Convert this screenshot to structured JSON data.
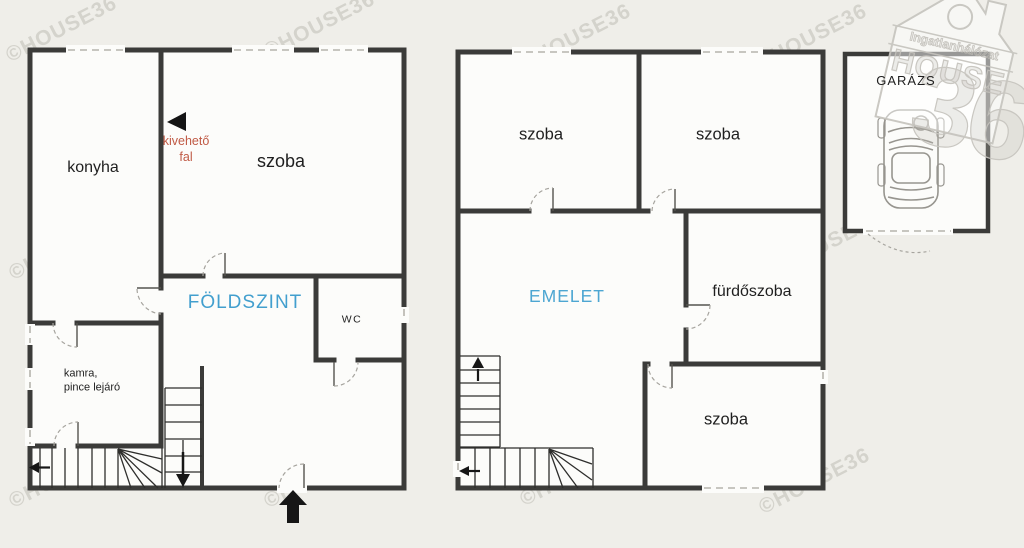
{
  "watermark": {
    "text": "©HOUSE36"
  },
  "floors": {
    "ground": {
      "title": "FÖLDSZINT",
      "kitchen": "konyha",
      "room": "szoba",
      "wc": "WC",
      "pantry": "kamra,\npince lejáró",
      "removable_wall_note": "kivehető\nfal"
    },
    "upper": {
      "title": "EMELET",
      "room_top_left": "szoba",
      "room_top_right": "szoba",
      "bathroom": "fürdőszoba",
      "room_bottom": "szoba"
    },
    "garage": {
      "title": "GARÁZS"
    }
  },
  "logo": {
    "tagline": "Ingatlanhálózat",
    "brand": "HOUSE",
    "number": "36"
  },
  "colors": {
    "background": "#efeee9",
    "room_fill": "#fcfcfa",
    "wall": "#3b3b39",
    "accent_blue": "#429fce",
    "accent_red": "#c05a45",
    "arrow_black": "#161616"
  }
}
